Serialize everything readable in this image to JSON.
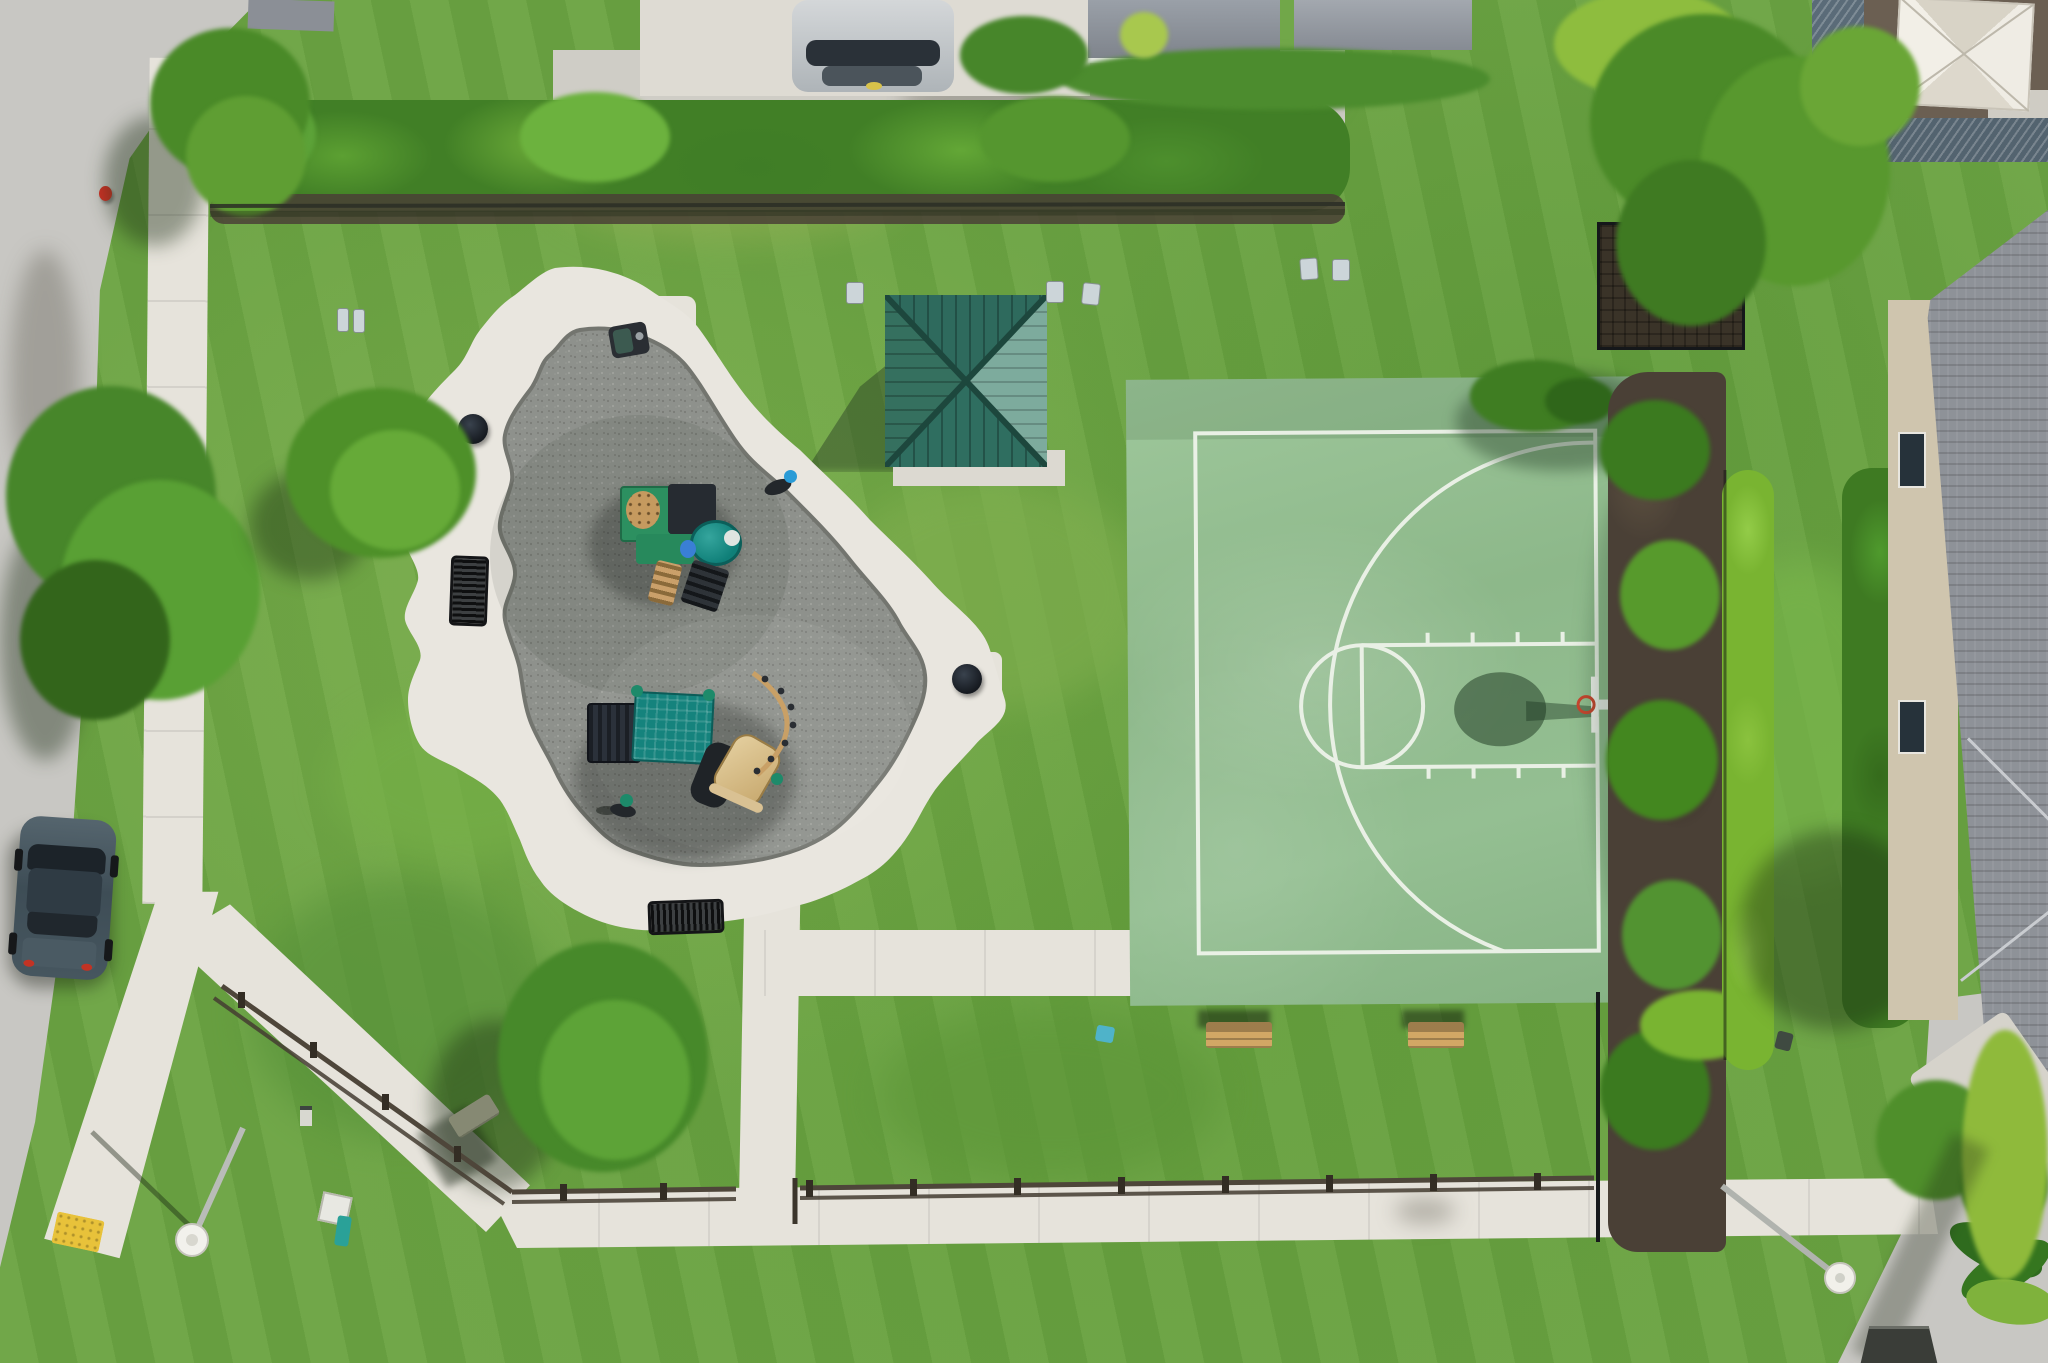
{
  "scene": {
    "kind": "aerial-drone-photo",
    "subject": "community park with playground, shade pavilion and half basketball court",
    "objects": [
      "road",
      "sidewalk-network",
      "playground-rubber-surface",
      "play-structure-small",
      "play-structure-large",
      "spring-riders",
      "shade-pavilion",
      "basketball-half-court",
      "basketball-hoop",
      "benches",
      "trash-cans",
      "bbq-grill",
      "split-rail-fence",
      "hedgerows",
      "lamp-posts",
      "fire-hydrant",
      "parked-car",
      "houses",
      "patio-umbrella",
      "palm-plants",
      "storm-drain"
    ],
    "counts": {
      "metal_benches": 2,
      "wood_benches": 2,
      "trash_cans": 2,
      "lamp_posts": 2,
      "play_structures": 2,
      "spring_riders": 2
    }
  },
  "colors": {
    "grass_base": "#6ba342",
    "grass_dark": "#4f8a31",
    "grass_light": "#7db54c",
    "road": "#c8c7c3",
    "concrete": "#e6e3db",
    "rubber_gray": "#8e918c",
    "court_green": "#92bd90",
    "court_line": "#eef3ea",
    "pavilion_dark": "#2e6a5d",
    "pavilion_light": "#7dab9d",
    "hedge_green": "#4d8f2d",
    "hedge_bright": "#79b431",
    "mulch": "#4a4036",
    "roof_gray": "#8e9298",
    "roof_metal": "#5a6b78",
    "umbrella_cream": "#eae6dc",
    "equip_green": "#1d8a6a",
    "equip_teal": "#15837d",
    "equip_navy": "#23272e",
    "equip_tan": "#c8a066",
    "bench_tan": "#d2a765",
    "car_body": "#46565f",
    "hydrant_red": "#cf3226",
    "curb_yellow": "#e8c23a"
  }
}
